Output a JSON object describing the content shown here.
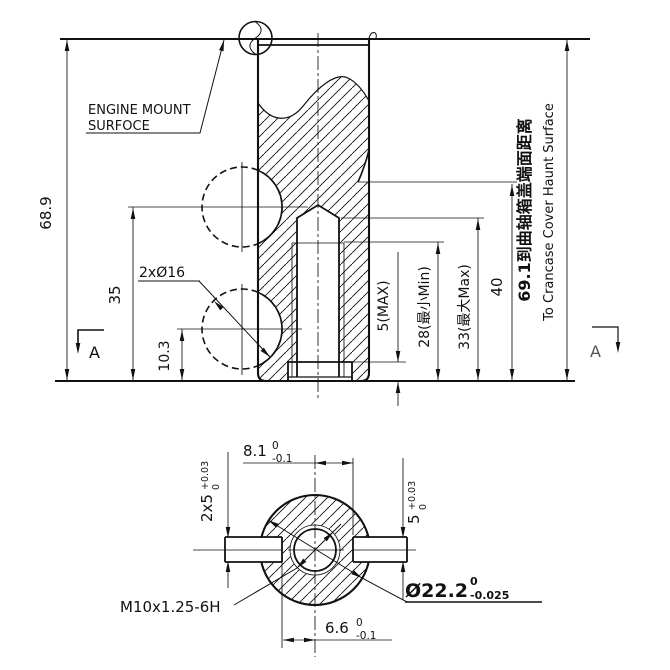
{
  "front_view": {
    "mount_label_line1": "ENGINE MOUNT",
    "mount_label_line2": "SURFOCE",
    "dim_overall_height": "68.9",
    "dim_upper_hole_height": "35",
    "dim_lower_hole_height": "10.3",
    "dim_holes_callout": "2xØ16",
    "dim_recess_depth": "5(MAX)",
    "dim_thread_depth_min": "28(最小Min)",
    "dim_drill_depth_max": "33(最大Max)",
    "dim_step_height": "40",
    "dim_crankcase_cn": "69.1到曲轴箱盖端面距离",
    "dim_crankcase_en": "To Crancase Cover Haunt Surface",
    "section_letter": "A"
  },
  "section_view": {
    "dim_slot_top_value": "8.1",
    "dim_slot_top_upper": "0",
    "dim_slot_top_lower": "-0.1",
    "dim_slot_bottom_value": "6.6",
    "dim_slot_bottom_upper": "0",
    "dim_slot_bottom_lower": "-0.1",
    "dim_slot_left_value": "2x5",
    "dim_slot_left_upper": "+0.03",
    "dim_slot_left_lower": "0",
    "dim_slot_right_value": "5",
    "dim_slot_right_upper": "+0.03",
    "dim_slot_right_lower": "0",
    "dim_thread_callout": "M10x1.25-6H",
    "dim_boss_diameter_value": "Ø22.2",
    "dim_boss_diameter_upper": "0",
    "dim_boss_diameter_lower": "-0.025"
  },
  "colors": {
    "line": "#111111",
    "background": "#ffffff",
    "muted": "#555555"
  }
}
